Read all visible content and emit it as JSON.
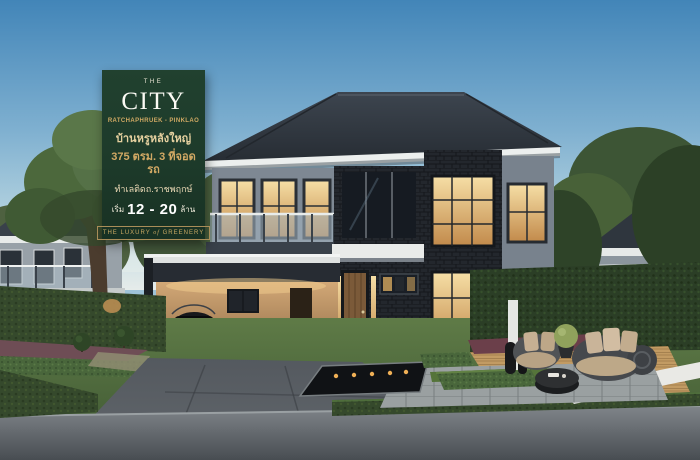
{
  "banner": {
    "brand_top": "THE",
    "brand_name": "CITY",
    "brand_location": "RATCHAPHRUEK - PINKLAO",
    "headline": "บ้านหรูหลังใหญ่",
    "spec_line": "375 ตรม. 3 ที่จอดรถ",
    "location_line": "ทำเลติดถ.ราชพฤกษ์",
    "price_prefix": "เริ่ม",
    "price_range": "12 - 20",
    "price_unit": "ล้าน",
    "tagline_pre": "THE LUXURY",
    "tagline_mid": "of",
    "tagline_post": "GREENERY",
    "colors": {
      "background": "#1d3a2a",
      "gold": "#cfa963",
      "cream": "#f1ecdb",
      "white": "#ffffff"
    }
  },
  "scene": {
    "colors": {
      "sky_top": "#4285b8",
      "sky_horizon": "#e6ecea",
      "roof_dark": "#333a43",
      "wall_gray": "#7e8893",
      "stone_dark": "#23272d",
      "window_warm": "#e9c27c",
      "lawn_green": "#54703f",
      "hedge_green": "#35492c",
      "road_gray": "#5c6165",
      "deck_wood": "#c29b63",
      "car_white": "#e8eaeb",
      "car_dark": "#16181b"
    },
    "objects": [
      "sky",
      "background-trees",
      "neighbor-house-left",
      "neighbor-house-right",
      "main-house",
      "balcony",
      "entrance-tower",
      "front-door",
      "carport",
      "suv-car",
      "sedan-car",
      "sports-car",
      "reflecting-pool",
      "stone-walkway",
      "wood-deck",
      "outdoor-sofa",
      "outdoor-armchair",
      "coffee-table",
      "potted-plant",
      "hedges",
      "topiary-balls",
      "lawn",
      "driveway",
      "road"
    ]
  }
}
